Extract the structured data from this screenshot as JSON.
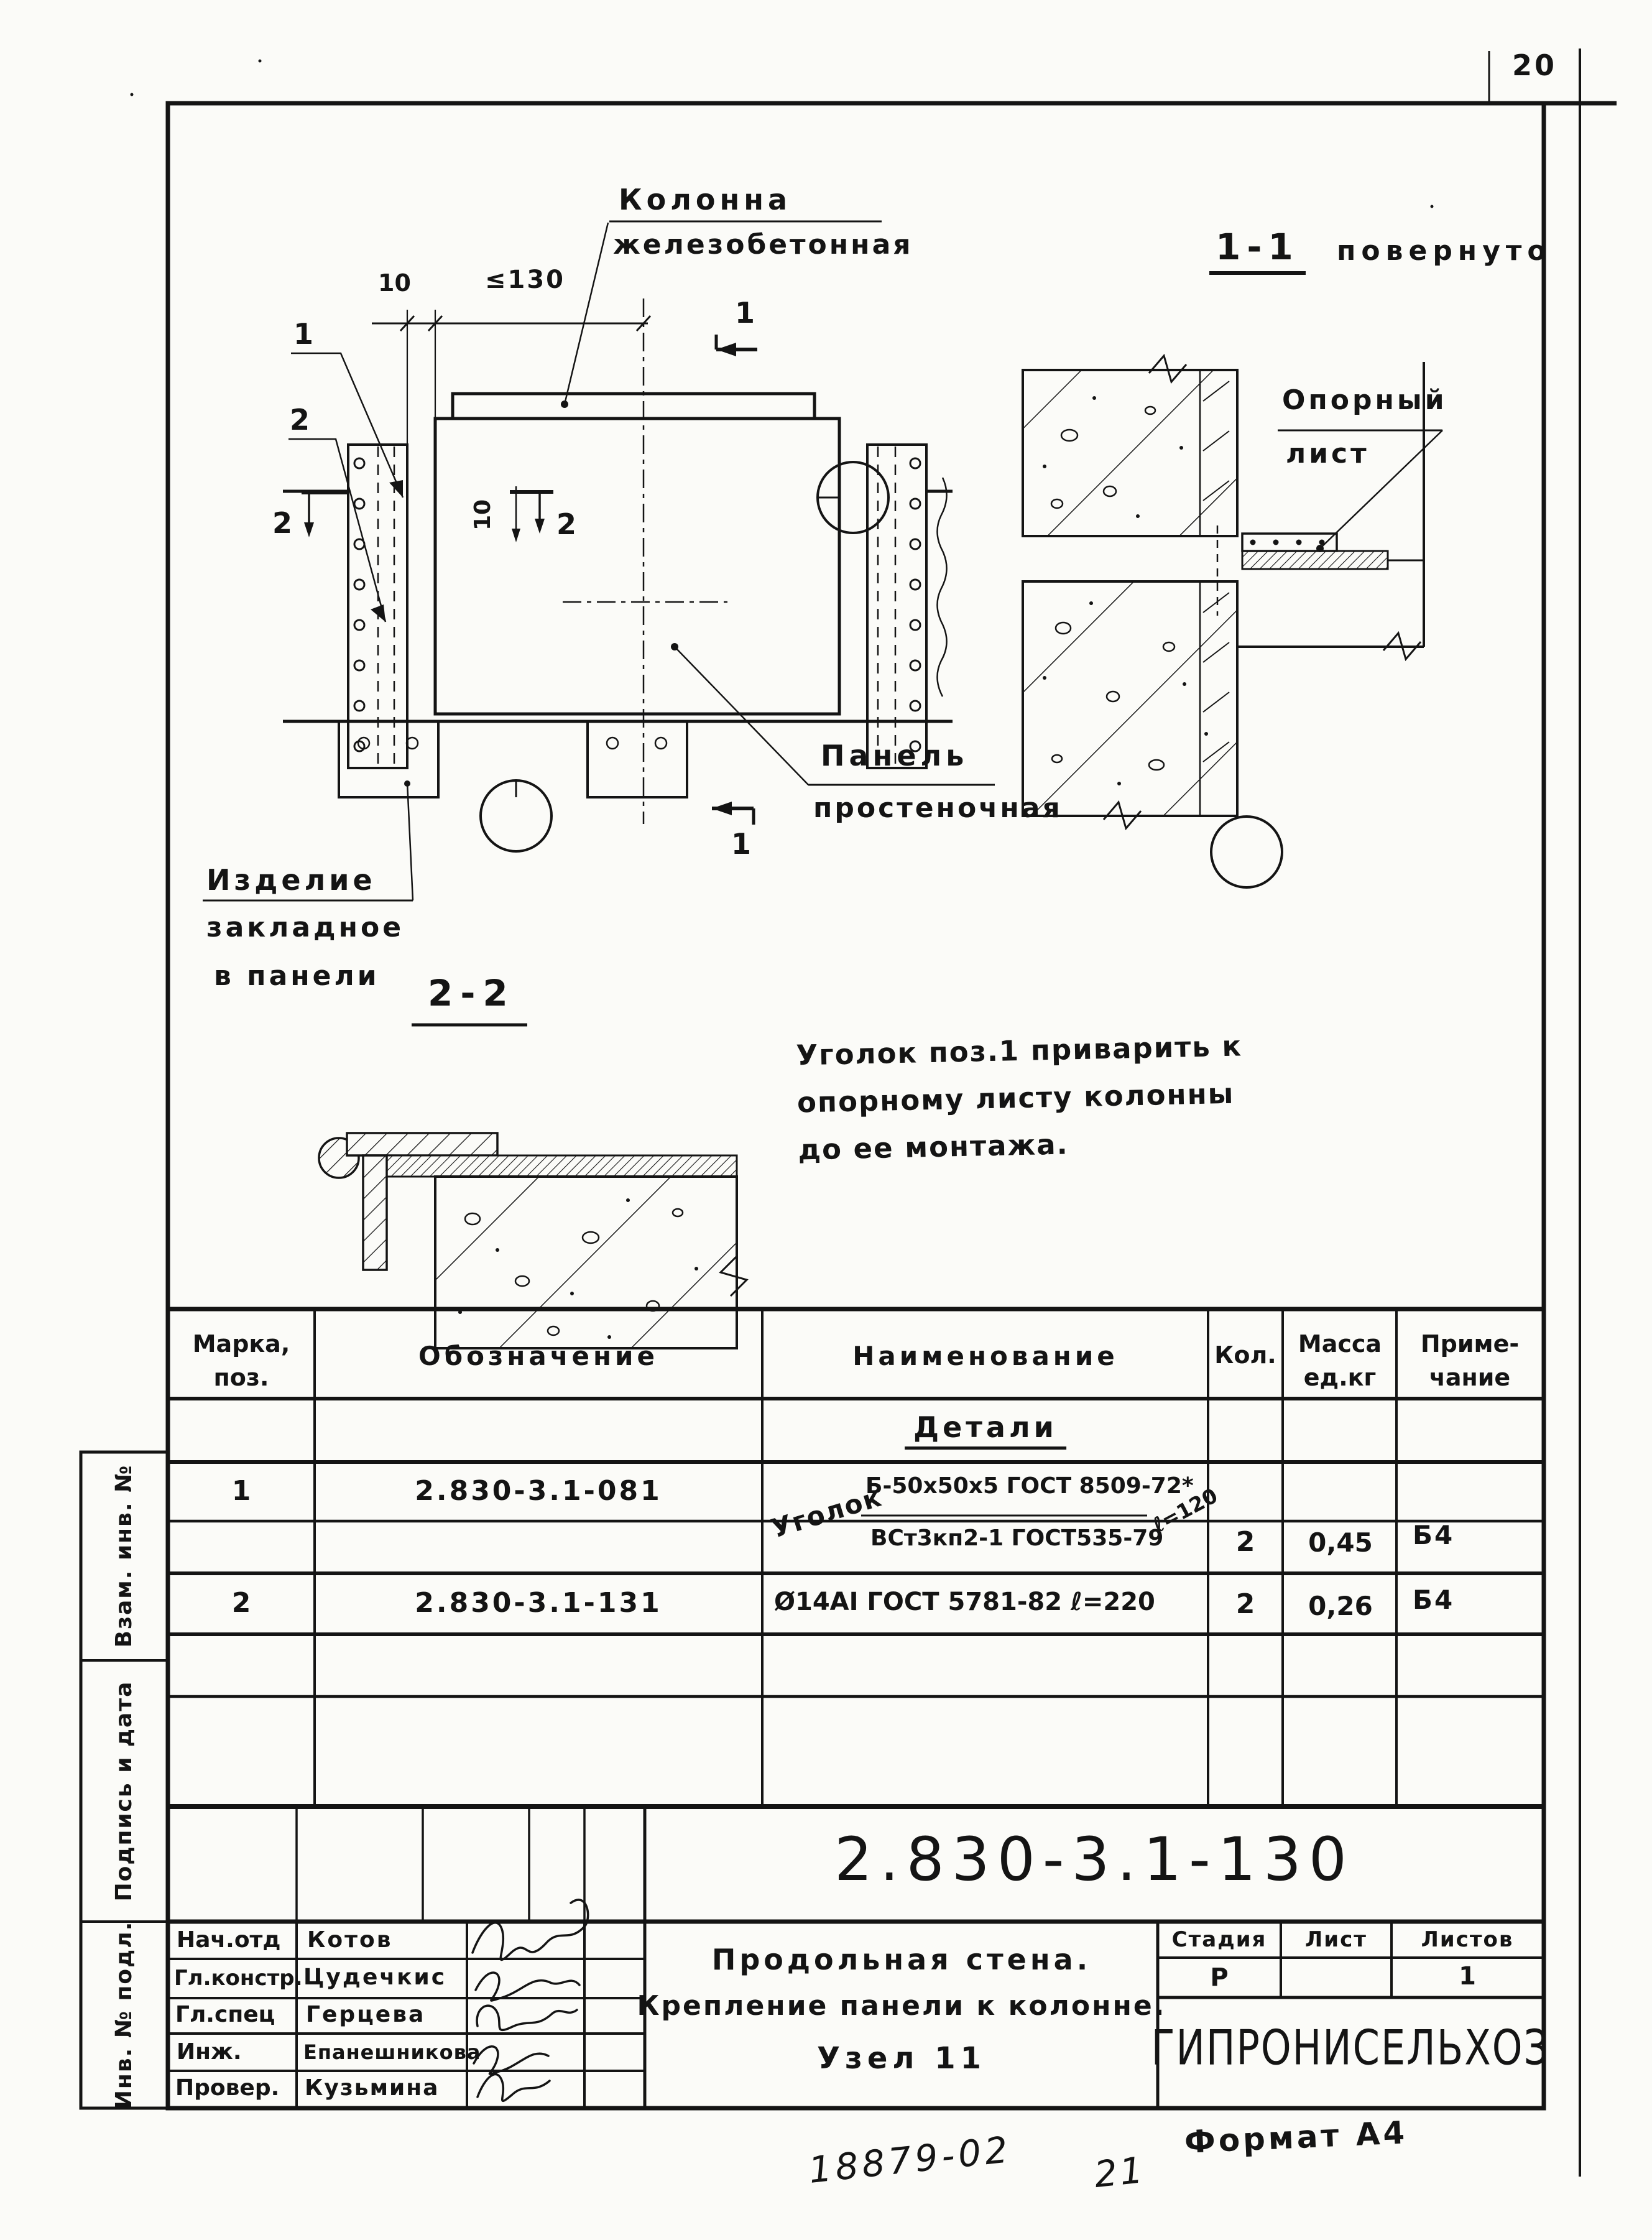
{
  "page": {
    "number": "20",
    "doc_code": "18879-02",
    "sheet_note": "21",
    "format": "Формат А4"
  },
  "drawing": {
    "col_label": [
      "Колонна",
      "железобетонная"
    ],
    "view11": {
      "label": "1-1",
      "note": "повернуто"
    },
    "support": [
      "Опорный",
      "лист"
    ],
    "panel": [
      "Панель",
      "простеночная"
    ],
    "embed": [
      "Изделие",
      "закладное",
      "в панели"
    ],
    "section22": "2-2",
    "dims": {
      "gap": "10",
      "max": "≤130",
      "inner": "10"
    },
    "callouts": {
      "c1": "1",
      "c2": "2"
    },
    "marks": {
      "m1": "1",
      "m2": "2"
    },
    "note": [
      "Уголок поз.1 приварить к",
      "опорному листу колонны",
      "до ее монтажа."
    ]
  },
  "parts_table": {
    "headers": {
      "mark1": "Марка,",
      "mark2": "поз.",
      "designation": "Обозначение",
      "name": "Наименование",
      "qty": "Кол.",
      "mass1": "Масса",
      "mass2": "ед.кг",
      "note1": "Приме-",
      "note2": "чание"
    },
    "group_title": "Детали",
    "rows": [
      {
        "mark": "1",
        "designation": "2.830-3.1-081",
        "prefix": "Уголок",
        "num": "Б-50х50х5 ГОСТ 8509-72*",
        "len": "ℓ=120",
        "den": "ВСт3кп2-1 ГОСТ535-79",
        "qty": "2",
        "mass": "0,45",
        "note": "Б4"
      },
      {
        "mark": "2",
        "designation": "2.830-3.1-131",
        "name": "Ø14АI ГОСТ 5781-82   ℓ=220",
        "qty": "2",
        "mass": "0,26",
        "note": "Б4"
      }
    ]
  },
  "title_block": {
    "doc_number": "2.830-3.1-130",
    "title": [
      "Продольная стена.",
      "Крепление панели к колонне.",
      "Узел 11"
    ],
    "stage_label": "Стадия",
    "sheet_label": "Лист",
    "sheets_label": "Листов",
    "stage": "Р",
    "sheets": "1",
    "organization": "ГИПРОНИСЕЛЬХОЗ",
    "staff": [
      {
        "role": "Нач.отд",
        "name": "Котов"
      },
      {
        "role": "Гл.констр.",
        "name": "Цудечкис"
      },
      {
        "role": "Гл.спец",
        "name": "Герцева"
      },
      {
        "role": "Инж.",
        "name": "Епанешникова"
      },
      {
        "role": "Провер.",
        "name": "Кузьмина"
      }
    ]
  },
  "sidebar": {
    "items": [
      "Взам. инв. №",
      "Подпись и дата",
      "Инв. № подл."
    ]
  }
}
